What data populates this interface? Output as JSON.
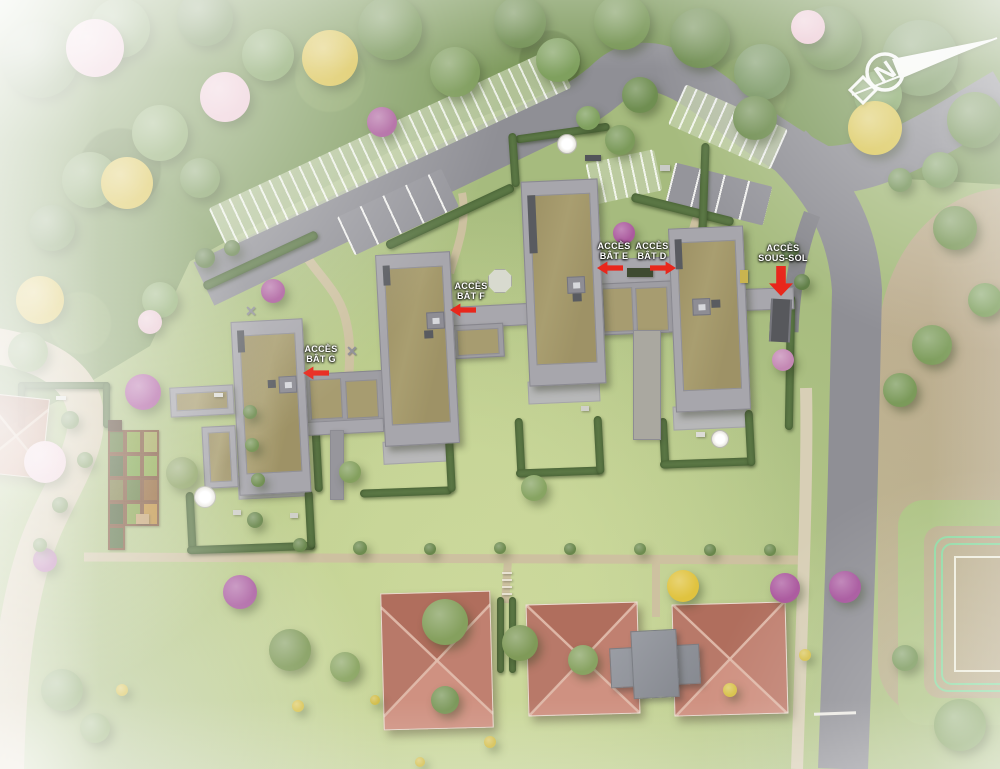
{
  "title": "Plan de masse aérien — résidence avec bâtiments D, E, F, G",
  "compass": {
    "letter": "N"
  },
  "access_labels": [
    {
      "id": "acces-bat-g",
      "lines": [
        "ACCÈS",
        "BÂT G"
      ],
      "x": 321,
      "y": 344,
      "arrow": {
        "dir": "left",
        "x": 316,
        "y": 373
      }
    },
    {
      "id": "acces-bat-f",
      "lines": [
        "ACCÈS",
        "BÂT F"
      ],
      "x": 471,
      "y": 281,
      "arrow": {
        "dir": "left",
        "x": 463,
        "y": 310
      }
    },
    {
      "id": "acces-bat-e",
      "lines": [
        "ACCÈS",
        "BÂT E"
      ],
      "x": 614,
      "y": 241,
      "arrow": {
        "dir": "left",
        "x": 610,
        "y": 268
      }
    },
    {
      "id": "acces-bat-d",
      "lines": [
        "ACCÈS",
        "BÂT D"
      ],
      "x": 652,
      "y": 241,
      "arrow": {
        "dir": "right",
        "x": 663,
        "y": 268
      }
    },
    {
      "id": "acces-sous-sol",
      "lines": [
        "ACCÈS",
        "SOUS-SOL"
      ],
      "x": 783,
      "y": 243,
      "arrow": {
        "dir": "down",
        "x": 781,
        "y": 281
      }
    }
  ],
  "buildings": [
    {
      "id": "G",
      "roof": "green"
    },
    {
      "id": "F",
      "roof": "green"
    },
    {
      "id": "E",
      "roof": "green"
    },
    {
      "id": "D",
      "roof": "green"
    }
  ],
  "colors": {
    "grass": "#a6bb7e",
    "forest": "#7e9a5d",
    "road": "#8f8f95",
    "path": "#cdc1a0",
    "lane": "#d3c7aa",
    "concrete": "#a7a6ac",
    "green_roof": "#a99e70",
    "red_roof": "#c08070",
    "arrow_red": "#e8271c",
    "hedge": "#5a7644",
    "brown_field": "#b5a689",
    "track_green": "#82d8a2",
    "label_text": "#ffffff"
  },
  "site": {
    "trees": [
      {
        "x": 40,
        "y": 60,
        "r": 38,
        "c": "#6f8c51"
      },
      {
        "x": 120,
        "y": 28,
        "r": 30,
        "c": "#7b9a5c"
      },
      {
        "x": 205,
        "y": 18,
        "r": 28,
        "c": "#6c8a4f"
      },
      {
        "x": 268,
        "y": 55,
        "r": 26,
        "c": "#7fa05f"
      },
      {
        "x": 330,
        "y": 58,
        "r": 28,
        "c": "#d9c24f"
      },
      {
        "x": 390,
        "y": 28,
        "r": 32,
        "c": "#70904f"
      },
      {
        "x": 455,
        "y": 72,
        "r": 25,
        "c": "#7b9a58"
      },
      {
        "x": 520,
        "y": 22,
        "r": 26,
        "c": "#6d8c4e"
      },
      {
        "x": 558,
        "y": 60,
        "r": 22,
        "c": "#7fa05e"
      },
      {
        "x": 622,
        "y": 22,
        "r": 28,
        "c": "#72924f"
      },
      {
        "x": 700,
        "y": 38,
        "r": 30,
        "c": "#6b8a4c"
      },
      {
        "x": 762,
        "y": 72,
        "r": 28,
        "c": "#75945e"
      },
      {
        "x": 830,
        "y": 38,
        "r": 32,
        "c": "#6f8e50"
      },
      {
        "x": 920,
        "y": 58,
        "r": 38,
        "c": "#74935a"
      },
      {
        "x": 975,
        "y": 120,
        "r": 28,
        "c": "#6e8d50"
      },
      {
        "x": 878,
        "y": 95,
        "r": 24,
        "c": "#7ea25f"
      },
      {
        "x": 808,
        "y": 27,
        "r": 17,
        "c": "#ebc7d2"
      },
      {
        "x": 95,
        "y": 48,
        "r": 29,
        "c": "#e9c4cf"
      },
      {
        "x": 225,
        "y": 97,
        "r": 25,
        "c": "#ecc9d4"
      },
      {
        "x": 875,
        "y": 128,
        "r": 27,
        "c": "#d9c553"
      },
      {
        "x": 940,
        "y": 170,
        "r": 18,
        "c": "#7b9b5e"
      },
      {
        "x": 90,
        "y": 180,
        "r": 28,
        "c": "#7d9c5c"
      },
      {
        "x": 160,
        "y": 133,
        "r": 28,
        "c": "#85a463"
      },
      {
        "x": 52,
        "y": 228,
        "r": 23,
        "c": "#6f8e51"
      },
      {
        "x": 127,
        "y": 183,
        "r": 26,
        "c": "#d8c14c"
      },
      {
        "x": 200,
        "y": 178,
        "r": 20,
        "c": "#7a995a"
      },
      {
        "x": 40,
        "y": 300,
        "r": 24,
        "c": "#d4bd4a"
      },
      {
        "x": 28,
        "y": 352,
        "r": 20,
        "c": "#7d9b5b"
      },
      {
        "x": 160,
        "y": 300,
        "r": 18,
        "c": "#87a765"
      },
      {
        "x": 150,
        "y": 322,
        "r": 12,
        "c": "#e8c4cf"
      },
      {
        "x": 205,
        "y": 258,
        "r": 10,
        "c": "#5f7d45"
      },
      {
        "x": 232,
        "y": 248,
        "r": 8,
        "c": "#627f47"
      },
      {
        "x": 640,
        "y": 95,
        "r": 18,
        "c": "#6f8e51"
      },
      {
        "x": 755,
        "y": 118,
        "r": 22,
        "c": "#6d8c4e"
      },
      {
        "x": 620,
        "y": 140,
        "r": 15,
        "c": "#7b9a5a"
      },
      {
        "x": 588,
        "y": 118,
        "r": 12,
        "c": "#7fa05e"
      },
      {
        "x": 382,
        "y": 122,
        "r": 15,
        "c": "#a85898"
      },
      {
        "x": 273,
        "y": 291,
        "r": 12,
        "c": "#a85598"
      },
      {
        "x": 143,
        "y": 392,
        "r": 18,
        "c": "#a9559c"
      },
      {
        "x": 45,
        "y": 462,
        "r": 21,
        "c": "#ecc8d3"
      },
      {
        "x": 182,
        "y": 473,
        "r": 16,
        "c": "#8aa05f"
      },
      {
        "x": 624,
        "y": 233,
        "r": 11,
        "c": "#ab5a9e"
      },
      {
        "x": 534,
        "y": 488,
        "r": 13,
        "c": "#87a462"
      },
      {
        "x": 350,
        "y": 472,
        "r": 11,
        "c": "#84a05e"
      },
      {
        "x": 783,
        "y": 360,
        "r": 11,
        "c": "#c488b4"
      },
      {
        "x": 790,
        "y": 250,
        "r": 9,
        "c": "#62814a"
      },
      {
        "x": 802,
        "y": 282,
        "r": 8,
        "c": "#5f7e46"
      },
      {
        "x": 900,
        "y": 390,
        "r": 17,
        "c": "#7b9a5a"
      },
      {
        "x": 932,
        "y": 345,
        "r": 20,
        "c": "#7f9e5e"
      },
      {
        "x": 955,
        "y": 228,
        "r": 22,
        "c": "#789656"
      },
      {
        "x": 985,
        "y": 300,
        "r": 17,
        "c": "#7fa05f"
      },
      {
        "x": 900,
        "y": 180,
        "r": 12,
        "c": "#729156"
      },
      {
        "x": 290,
        "y": 650,
        "r": 21,
        "c": "#7f9a58"
      },
      {
        "x": 345,
        "y": 667,
        "r": 15,
        "c": "#8aa562"
      },
      {
        "x": 445,
        "y": 622,
        "r": 23,
        "c": "#85a05e"
      },
      {
        "x": 520,
        "y": 643,
        "r": 18,
        "c": "#7f9a58"
      },
      {
        "x": 583,
        "y": 660,
        "r": 15,
        "c": "#88a362"
      },
      {
        "x": 240,
        "y": 592,
        "r": 17,
        "c": "#a85a9e"
      },
      {
        "x": 683,
        "y": 586,
        "r": 16,
        "c": "#e0c33f"
      },
      {
        "x": 785,
        "y": 588,
        "r": 15,
        "c": "#a9559c"
      },
      {
        "x": 845,
        "y": 587,
        "r": 16,
        "c": "#a4509a"
      },
      {
        "x": 960,
        "y": 725,
        "r": 26,
        "c": "#84a260"
      },
      {
        "x": 905,
        "y": 658,
        "r": 13,
        "c": "#79985a"
      },
      {
        "x": 62,
        "y": 690,
        "r": 21,
        "c": "#82a05f"
      },
      {
        "x": 95,
        "y": 728,
        "r": 15,
        "c": "#8aa764"
      },
      {
        "x": 45,
        "y": 560,
        "r": 12,
        "c": "#b06aa6"
      },
      {
        "x": 445,
        "y": 700,
        "r": 14,
        "c": "#7b985a"
      },
      {
        "x": 730,
        "y": 690,
        "r": 7,
        "c": "#d8c24a"
      },
      {
        "x": 805,
        "y": 655,
        "r": 6,
        "c": "#d6c04a"
      },
      {
        "x": 490,
        "y": 742,
        "r": 6,
        "c": "#d4be4a"
      },
      {
        "x": 298,
        "y": 706,
        "r": 6,
        "c": "#d6c149"
      },
      {
        "x": 375,
        "y": 700,
        "r": 5,
        "c": "#d2bd48"
      },
      {
        "x": 122,
        "y": 690,
        "r": 6,
        "c": "#d4bf4b"
      },
      {
        "x": 420,
        "y": 762,
        "r": 5,
        "c": "#d2bd48"
      },
      {
        "x": 70,
        "y": 420,
        "r": 9,
        "c": "#6e8c50"
      },
      {
        "x": 85,
        "y": 460,
        "r": 8,
        "c": "#71904f"
      },
      {
        "x": 60,
        "y": 505,
        "r": 8,
        "c": "#6e8c4e"
      },
      {
        "x": 40,
        "y": 545,
        "r": 7,
        "c": "#739252"
      },
      {
        "x": 255,
        "y": 520,
        "r": 8,
        "c": "#6a884d"
      },
      {
        "x": 258,
        "y": 480,
        "r": 7,
        "c": "#6e8d4f"
      },
      {
        "x": 252,
        "y": 445,
        "r": 7,
        "c": "#71904f"
      },
      {
        "x": 250,
        "y": 412,
        "r": 7,
        "c": "#6d8b4e"
      },
      {
        "x": 300,
        "y": 545,
        "r": 7,
        "c": "#68864b"
      },
      {
        "x": 360,
        "y": 548,
        "r": 7,
        "c": "#6d8b4f"
      },
      {
        "x": 430,
        "y": 549,
        "r": 6,
        "c": "#68864b"
      },
      {
        "x": 500,
        "y": 548,
        "r": 6,
        "c": "#6d8b4f"
      },
      {
        "x": 570,
        "y": 549,
        "r": 6,
        "c": "#68864b"
      },
      {
        "x": 640,
        "y": 549,
        "r": 6,
        "c": "#6d8b4f"
      },
      {
        "x": 710,
        "y": 550,
        "r": 6,
        "c": "#68864b"
      },
      {
        "x": 770,
        "y": 550,
        "r": 6,
        "c": "#6d8b4f"
      }
    ],
    "hedges": [
      {
        "x": 198,
        "y": 256,
        "w": 125,
        "h": 9,
        "rot": -25
      },
      {
        "x": 380,
        "y": 212,
        "w": 140,
        "h": 9,
        "rot": -25
      },
      {
        "x": 630,
        "y": 205,
        "w": 105,
        "h": 9,
        "rot": 14
      },
      {
        "x": 515,
        "y": 129,
        "w": 95,
        "h": 8,
        "rot": -8
      },
      {
        "x": 510,
        "y": 133,
        "w": 8,
        "h": 54,
        "rot": -4
      },
      {
        "x": 700,
        "y": 143,
        "w": 8,
        "h": 88,
        "rot": 2
      },
      {
        "x": 786,
        "y": 295,
        "w": 8,
        "h": 135,
        "rot": 1
      },
      {
        "x": 187,
        "y": 492,
        "w": 8,
        "h": 58,
        "rot": -3
      },
      {
        "x": 187,
        "y": 544,
        "w": 128,
        "h": 8,
        "rot": -2
      },
      {
        "x": 306,
        "y": 490,
        "w": 8,
        "h": 58,
        "rot": -3
      },
      {
        "x": 312,
        "y": 380,
        "w": 8,
        "h": 112,
        "rot": -3
      },
      {
        "x": 360,
        "y": 488,
        "w": 92,
        "h": 8,
        "rot": -2
      },
      {
        "x": 446,
        "y": 422,
        "w": 8,
        "h": 70,
        "rot": -3
      },
      {
        "x": 516,
        "y": 418,
        "w": 8,
        "h": 58,
        "rot": -3
      },
      {
        "x": 516,
        "y": 468,
        "w": 86,
        "h": 8,
        "rot": -2
      },
      {
        "x": 595,
        "y": 416,
        "w": 8,
        "h": 58,
        "rot": -3
      },
      {
        "x": 660,
        "y": 418,
        "w": 8,
        "h": 48,
        "rot": -3
      },
      {
        "x": 660,
        "y": 459,
        "w": 92,
        "h": 8,
        "rot": -2
      },
      {
        "x": 746,
        "y": 410,
        "w": 8,
        "h": 56,
        "rot": -3
      },
      {
        "x": 18,
        "y": 382,
        "w": 92,
        "h": 7,
        "rot": 0
      },
      {
        "x": 18,
        "y": 382,
        "w": 7,
        "h": 46,
        "rot": 0
      },
      {
        "x": 103,
        "y": 382,
        "w": 7,
        "h": 46,
        "rot": 0
      },
      {
        "x": 497,
        "y": 597,
        "w": 7,
        "h": 76,
        "rot": 0
      },
      {
        "x": 509,
        "y": 597,
        "w": 7,
        "h": 76,
        "rot": 0
      }
    ],
    "parking": [
      {
        "x": 390,
        "y": 148,
        "w": 380,
        "h": 44,
        "rot": -25,
        "kind": "pavers"
      },
      {
        "x": 728,
        "y": 127,
        "w": 112,
        "h": 44,
        "rot": 24,
        "kind": "pavers"
      },
      {
        "x": 624,
        "y": 177,
        "w": 70,
        "h": 42,
        "rot": -12,
        "kind": "pavers"
      },
      {
        "x": 398,
        "y": 212,
        "w": 115,
        "h": 42,
        "rot": -25,
        "kind": "stalls"
      },
      {
        "x": 719,
        "y": 194,
        "w": 100,
        "h": 40,
        "rot": 14,
        "kind": "stalls"
      }
    ],
    "garden_plots": {
      "x": 108,
      "y": 430,
      "cw": 17,
      "ch": 24,
      "rows": [
        [
          "#55702f",
          "#7f9c38",
          "#9a9f49"
        ],
        [
          "#41572b",
          "#6f9a36",
          "#83a23d"
        ],
        [
          "#707033",
          "#55702f",
          "#8a5a28"
        ],
        [
          "#3f5429",
          "#7b993a",
          "#b8862f"
        ]
      ],
      "extra": {
        "x": 108,
        "y": 526,
        "c": "#45602e"
      }
    },
    "props": [
      {
        "t": "pavilion",
        "x": 499,
        "y": 280,
        "s": 22
      },
      {
        "t": "umbrella",
        "x": 204,
        "y": 496,
        "s": 20
      },
      {
        "t": "umbrella",
        "x": 566,
        "y": 143,
        "s": 18
      },
      {
        "t": "umbrella",
        "x": 719,
        "y": 438,
        "s": 16
      },
      {
        "t": "playx",
        "x": 353,
        "y": 351
      },
      {
        "t": "playx",
        "x": 252,
        "y": 311
      },
      {
        "t": "rect",
        "x": 108,
        "y": 420,
        "w": 14,
        "h": 11,
        "c": "#4f3a28"
      },
      {
        "t": "rect",
        "x": 136,
        "y": 514,
        "w": 13,
        "h": 10,
        "c": "#bf9a66"
      },
      {
        "t": "rect",
        "x": 214,
        "y": 393,
        "w": 9,
        "h": 4,
        "c": "#dcdcd6"
      },
      {
        "t": "rect",
        "x": 56,
        "y": 396,
        "w": 10,
        "h": 4,
        "c": "#dcdcd6"
      },
      {
        "t": "rect",
        "x": 233,
        "y": 510,
        "w": 8,
        "h": 5,
        "c": "#d0d0c9"
      },
      {
        "t": "rect",
        "x": 290,
        "y": 513,
        "w": 8,
        "h": 5,
        "c": "#d0d0c9"
      },
      {
        "t": "rect",
        "x": 696,
        "y": 432,
        "w": 9,
        "h": 5,
        "c": "#dcdcd6"
      },
      {
        "t": "rect",
        "x": 581,
        "y": 406,
        "w": 8,
        "h": 5,
        "c": "#d0d0c9"
      },
      {
        "t": "rect",
        "x": 627,
        "y": 268,
        "w": 26,
        "h": 9,
        "c": "#3e4a30"
      },
      {
        "t": "rect",
        "x": 740,
        "y": 270,
        "w": 8,
        "h": 13,
        "c": "#c9b44f"
      },
      {
        "t": "rect",
        "x": 585,
        "y": 155,
        "w": 16,
        "h": 6,
        "c": "#53555a"
      },
      {
        "t": "rect",
        "x": 660,
        "y": 165,
        "w": 10,
        "h": 6,
        "c": "#c9cbc6"
      },
      {
        "t": "rect",
        "x": 502,
        "y": 572,
        "w": 10,
        "h": 2,
        "c": "#e8e2d2"
      },
      {
        "t": "rect",
        "x": 502,
        "y": 579,
        "w": 10,
        "h": 2,
        "c": "#e8e2d2"
      },
      {
        "t": "rect",
        "x": 502,
        "y": 586,
        "w": 10,
        "h": 2,
        "c": "#e8e2d2"
      },
      {
        "t": "rect",
        "x": 502,
        "y": 593,
        "w": 10,
        "h": 2,
        "c": "#e8e2d2"
      }
    ]
  }
}
